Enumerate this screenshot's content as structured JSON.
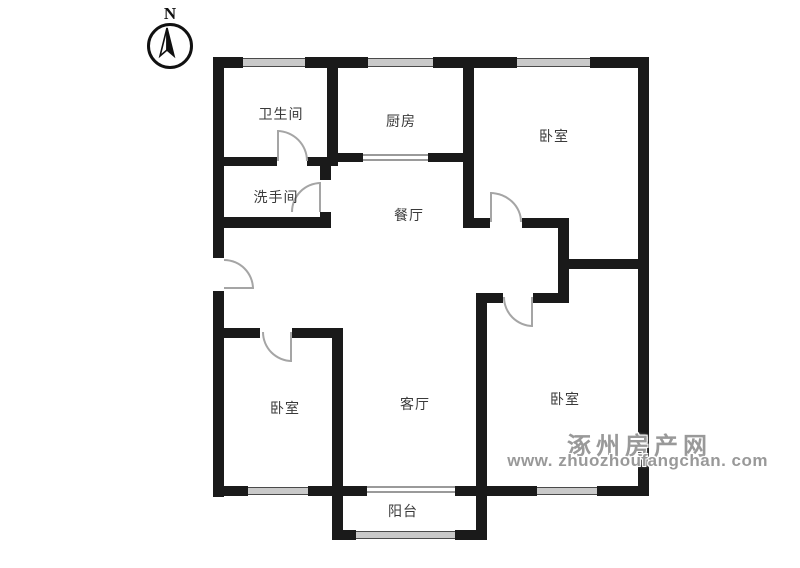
{
  "theme": {
    "background": "#ffffff",
    "wall": "#1a1a1a",
    "window_fill": "#c9c9c9",
    "door_arc": "#a5a5a5",
    "label": "#3a3a3a",
    "watermark": "#999999"
  },
  "compass": {
    "label": "N"
  },
  "rooms": [
    {
      "name": "bathroom",
      "label": "卫生间"
    },
    {
      "name": "kitchen",
      "label": "厨房"
    },
    {
      "name": "bedroom-north",
      "label": "卧室"
    },
    {
      "name": "washroom",
      "label": "洗手间"
    },
    {
      "name": "dining-room",
      "label": "餐厅"
    },
    {
      "name": "bedroom-southwest",
      "label": "卧室"
    },
    {
      "name": "living-room",
      "label": "客厅"
    },
    {
      "name": "bedroom-southeast",
      "label": "卧室"
    },
    {
      "name": "balcony",
      "label": "阳台"
    }
  ],
  "watermark": {
    "site_name": "涿州房产网",
    "site_url": "www. zhuozhoufangchan. com"
  }
}
